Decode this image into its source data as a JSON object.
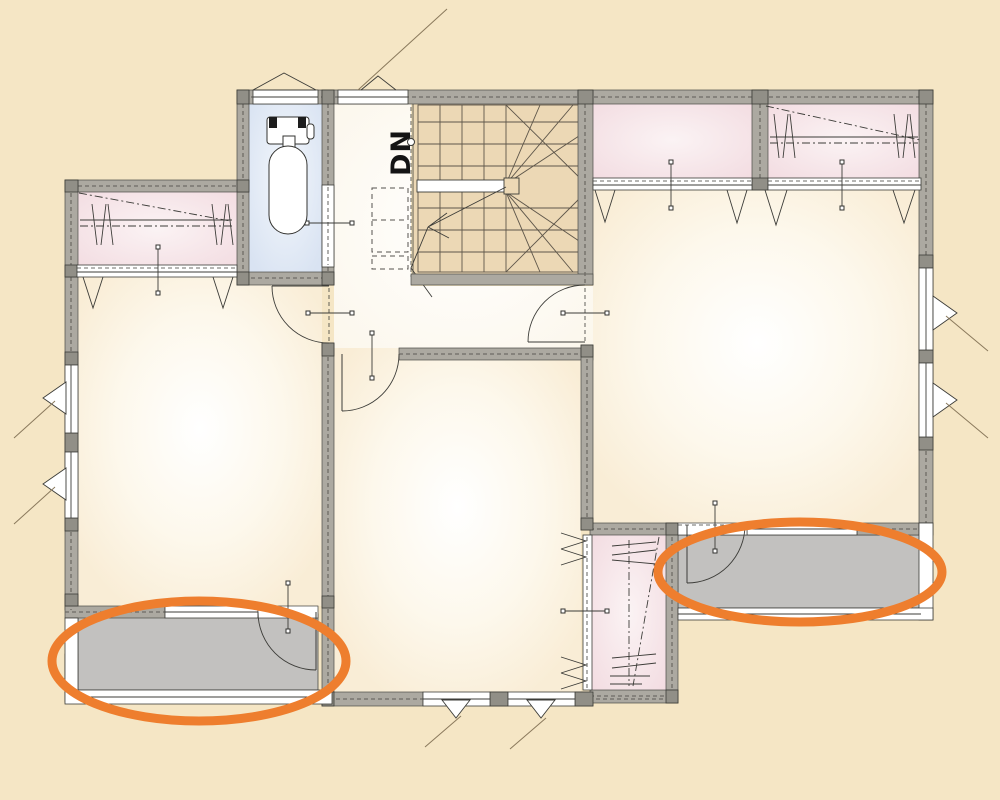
{
  "stairs": {
    "label": "DN"
  },
  "colors": {
    "background": "#F5E6C5",
    "wall": "#ACA9A1",
    "wall_post": "#918F87",
    "wall_dash": "#6E6C66",
    "room_center": "#FFFFFF",
    "room_mid": "#FDF8EC",
    "room_edge": "#F9EDD6",
    "hall_center": "#FFFFFF",
    "hall_edge": "#FCF7EC",
    "closet_pink_center": "#FBF3F4",
    "closet_pink_edge": "#F3DDE2",
    "toilet_center": "#F3F7FC",
    "toilet_edge": "#D9E3F2",
    "stair_tan": "#ECD8B5",
    "stair_line": "#5E564A",
    "balcony_gray": "#C2C1BF",
    "swing_brown": "#8A795C",
    "highlight_orange": "#EE7E2E"
  }
}
